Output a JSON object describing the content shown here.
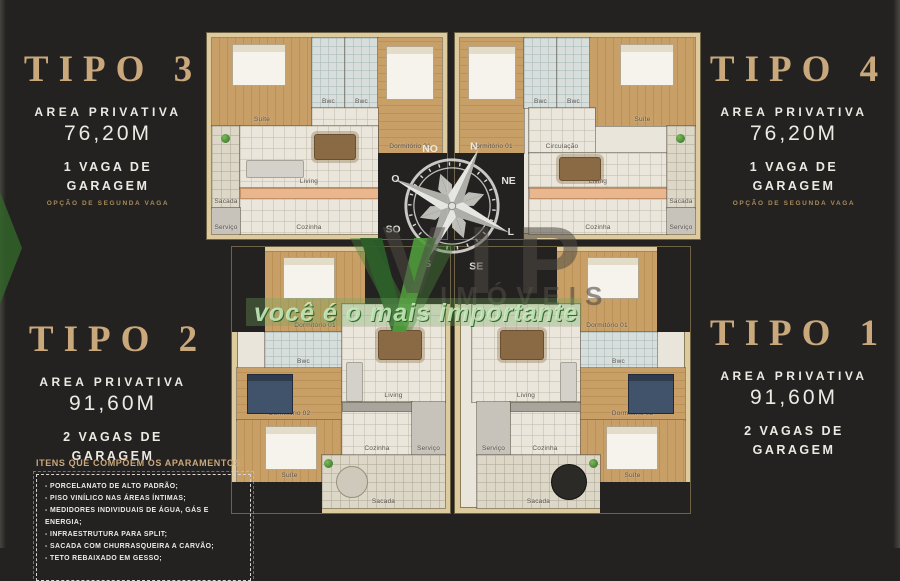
{
  "panels": {
    "tipo3": {
      "title": "TIPO 3",
      "area_label": "AREA PRIVATIVA",
      "area_value": "76,20M",
      "garage": "1 VAGA DE GARAGEM",
      "note": "OPÇÃO DE SEGUNDA VAGA"
    },
    "tipo4": {
      "title": "TIPO 4",
      "area_label": "AREA PRIVATIVA",
      "area_value": "76,20M",
      "garage": "1 VAGA DE GARAGEM",
      "note": "OPÇÃO DE SEGUNDA VAGA"
    },
    "tipo2": {
      "title": "TIPO 2",
      "area_label": "AREA PRIVATIVA",
      "area_value": "91,60M",
      "garage": "2 VAGAS DE GARAGEM"
    },
    "tipo1": {
      "title": "TIPO 1",
      "area_label": "AREA PRIVATIVA",
      "area_value": "91,60M",
      "garage": "2 VAGAS DE GARAGEM"
    }
  },
  "items_box": {
    "title": "ITENS QUE COMPÕEM OS APARAMENTOS:",
    "items": [
      "- PORCELANATO DE ALTO PADRÃO;",
      "- PISO VINÍLICO NAS ÁREAS ÍNTIMAS;",
      "- MEDIDORES INDIVIDUAIS DE ÁGUA, GÁS E ENERGIA;",
      "- INFRAESTRUTURA PARA SPLIT;",
      "- SACADA COM CHURRASQUEIRA A CARVÃO;",
      "- TETO REBAIXADO EM GESSO;"
    ]
  },
  "compass": {
    "n": "N",
    "ne": "NE",
    "l": "L",
    "se": "SE",
    "s": "S",
    "so": "SO",
    "o": "O",
    "no": "NO"
  },
  "watermark": {
    "brand": "VIP",
    "sub": "IMÓVEIS",
    "tagline": "você é o mais importante",
    "green": "#3c7a36"
  },
  "colors": {
    "background": "#242220",
    "gold": "#c9a87c",
    "text": "#edeae4",
    "wall": "#ddcb9e"
  },
  "plans": {
    "tipo3": {
      "rooms": [
        "Suíte",
        "Bwc",
        "Bwc",
        "Dormitório 01",
        "Circulação",
        "Sacada",
        "Living",
        "Cozinha",
        "Serviço"
      ]
    },
    "tipo4": {
      "rooms": [
        "Dormitório 01",
        "Bwc",
        "Bwc",
        "Suíte",
        "Circulação",
        "Living",
        "Cozinha",
        "Sacada",
        "Serviço"
      ]
    },
    "tipo2": {
      "rooms": [
        "Dormitório 01",
        "Bwc",
        "Dormitório 02",
        "Suíte",
        "Living",
        "Cozinha",
        "Serviço",
        "Sacada"
      ]
    },
    "tipo1": {
      "rooms": [
        "Dormitório 01",
        "Bwc",
        "Dormitório 02",
        "Suíte",
        "Living",
        "Cozinha",
        "Serviço",
        "Sacada"
      ]
    }
  }
}
